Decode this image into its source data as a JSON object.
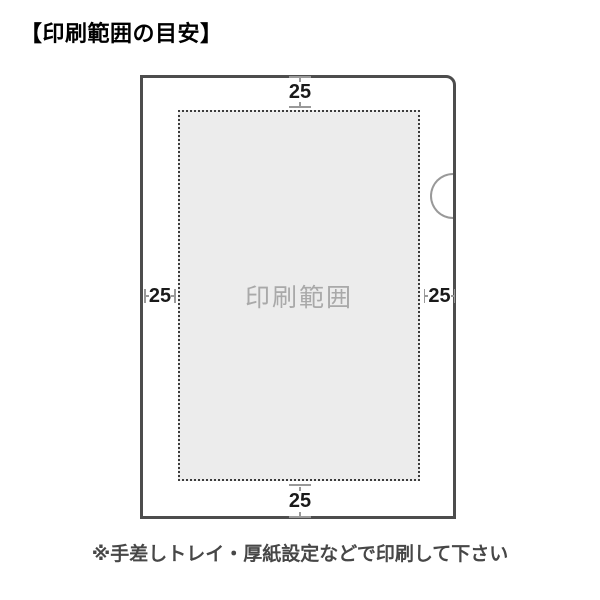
{
  "title": "【印刷範囲の目安】",
  "diagram": {
    "print_area_label": "印刷範囲",
    "margins": {
      "top": "25",
      "bottom": "25",
      "left": "25",
      "right": "25"
    }
  },
  "footnote": "※手差しトレイ・厚紙設定などで印刷して下さい",
  "colors": {
    "outline": "#4d4d4d",
    "dashed": "#3c3c3c",
    "area_fill": "#ececec",
    "watermark": "#a9a9a9",
    "measure": "#999999",
    "measure_text": "#1a1a1a",
    "title_text": "#000000",
    "note_text": "#474747",
    "page_bg": "#ffffff"
  }
}
